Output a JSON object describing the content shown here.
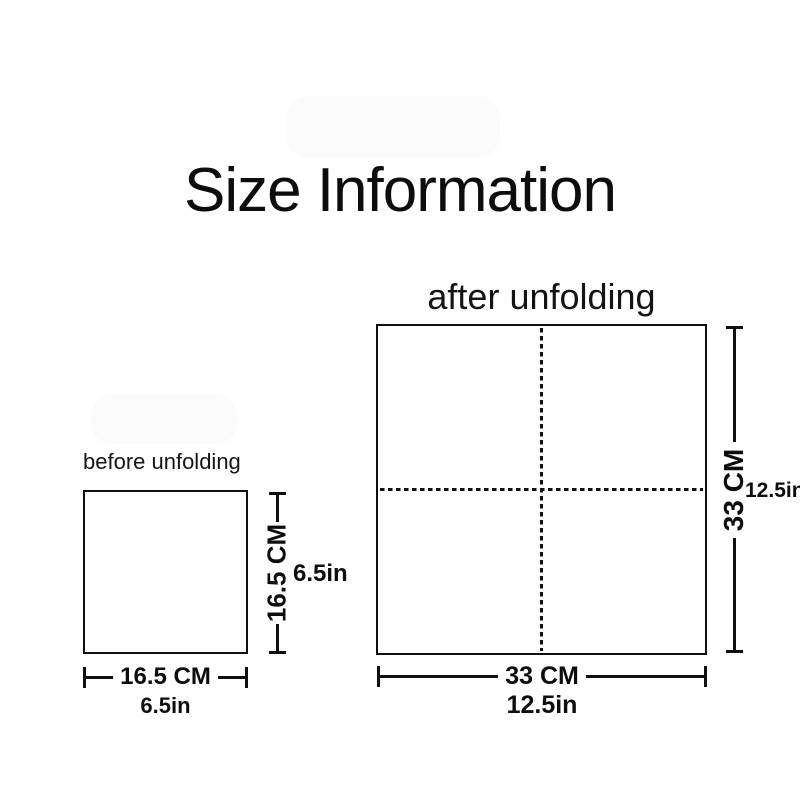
{
  "page": {
    "title": "Size Information"
  },
  "colors": {
    "ink": "#0f0f0f",
    "background": "#ffffff",
    "watermark_smudge": "#f7f8f9"
  },
  "panels": {
    "before": {
      "label": "before unfolding",
      "height_cm": "16.5 CM",
      "height_in": "6.5in",
      "width_cm": "16.5 CM",
      "width_in": "6.5in"
    },
    "after": {
      "label": "after unfolding",
      "height_cm": "33 CM",
      "height_in": "12.5in",
      "width_cm": "33 CM",
      "width_in": "12.5in"
    }
  }
}
